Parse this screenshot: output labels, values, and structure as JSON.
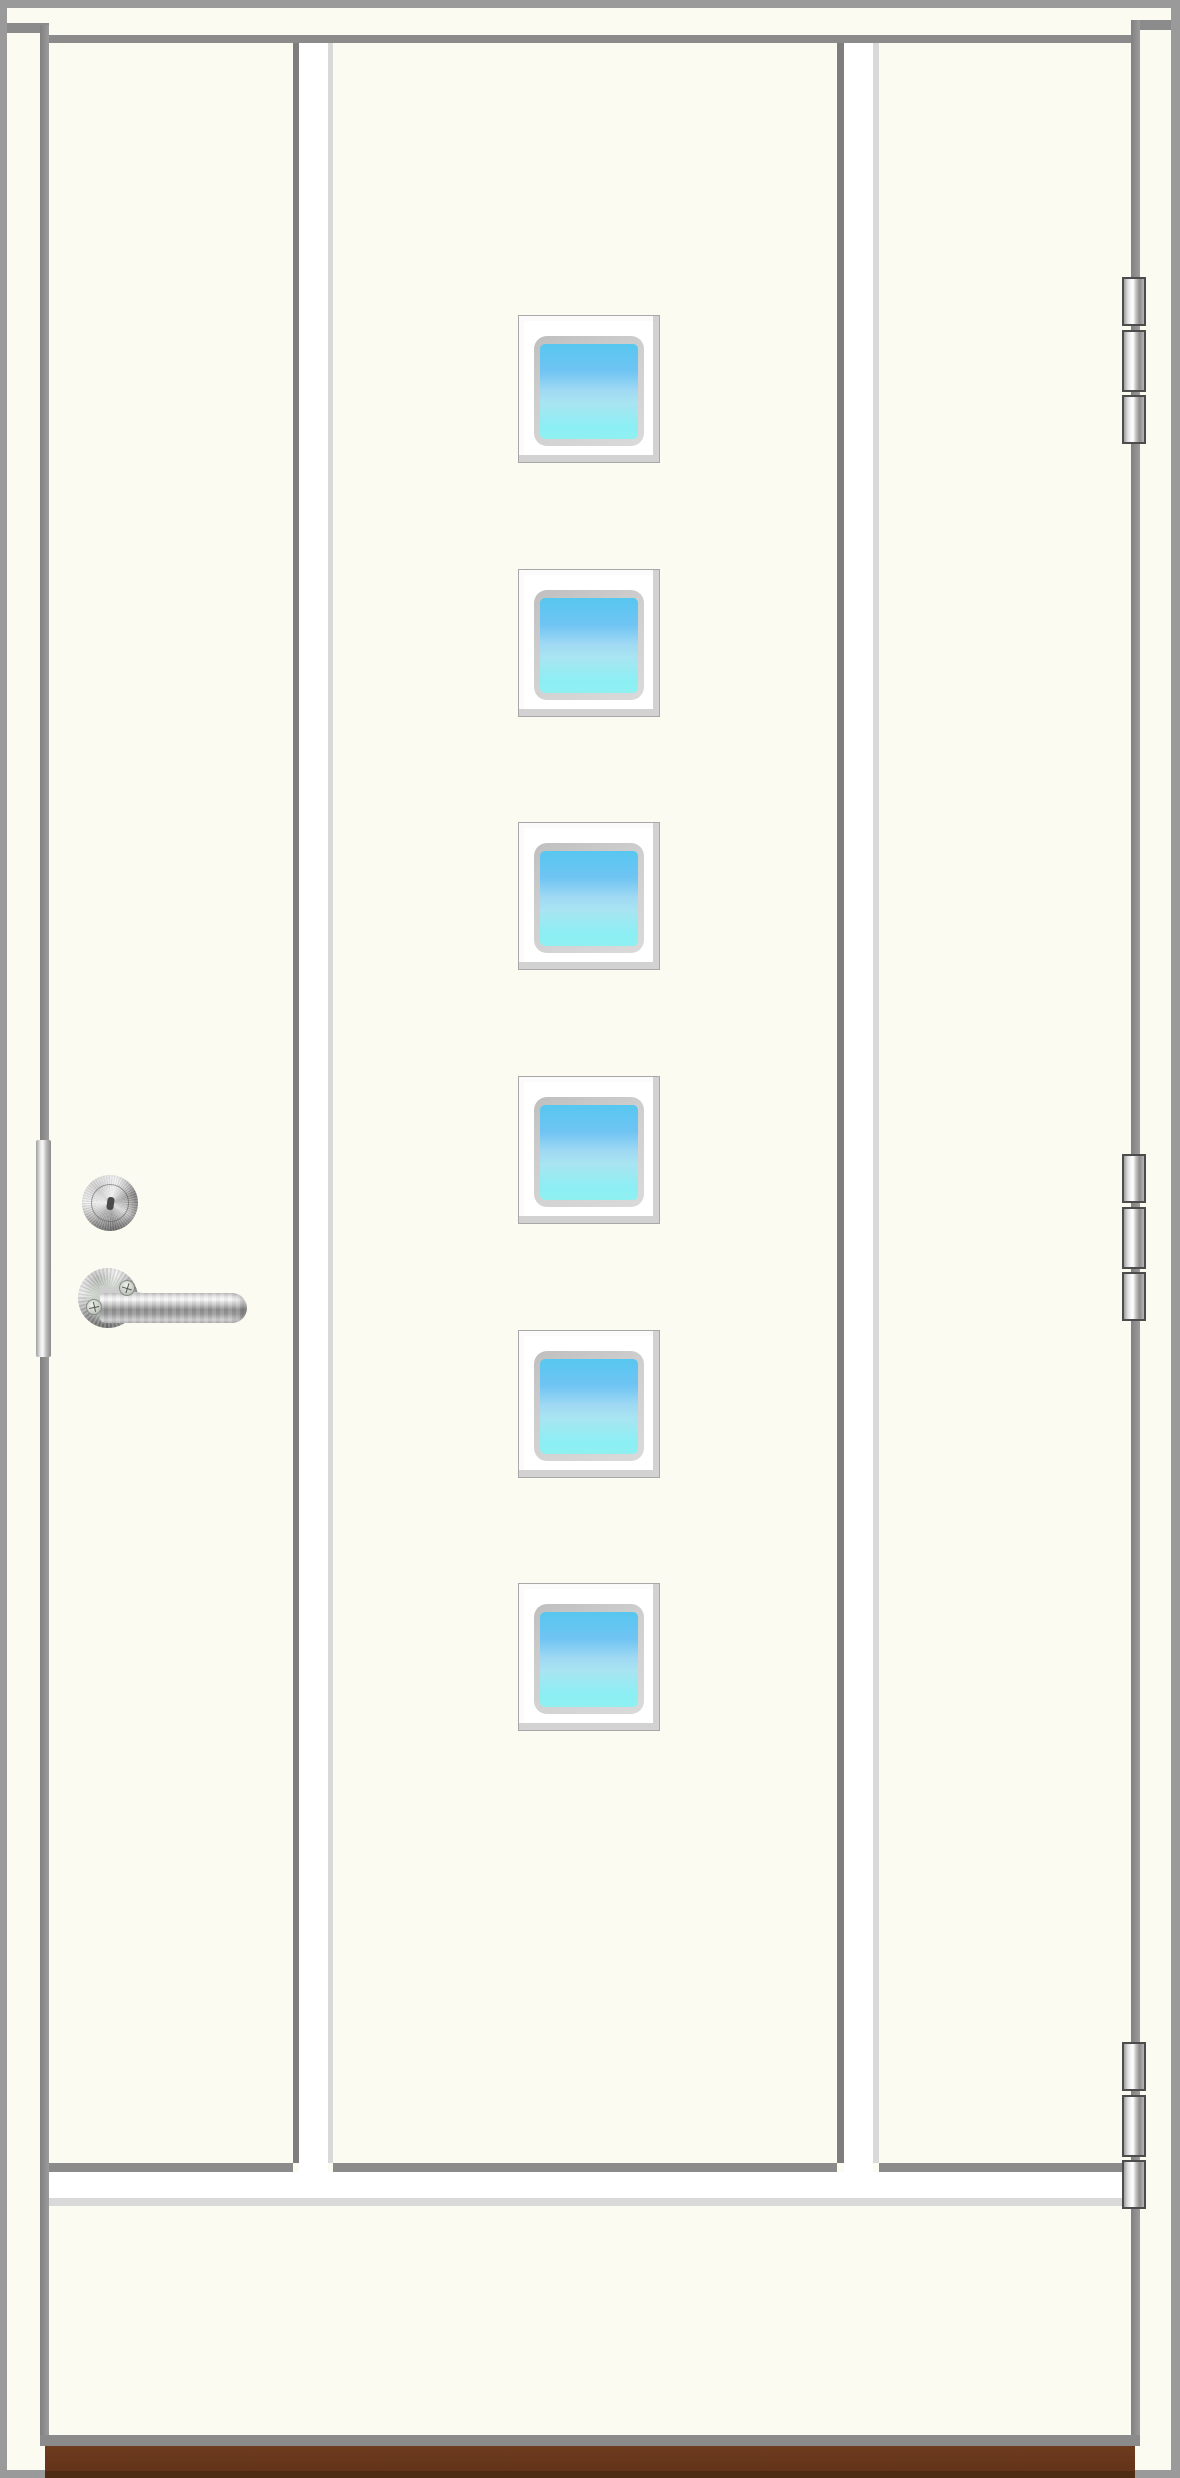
{
  "scene": {
    "kind": "exterior-door-product-illustration",
    "description": "White exterior entry door with six stacked square glass panes, stainless lever handle, keyed lock cylinder, edge strike plate, three hinges and brown threshold"
  },
  "door": {
    "panel_count": 3,
    "window_count": 6,
    "window_tops": [
      315,
      569,
      822,
      1076,
      1330,
      1583
    ],
    "hinge_count": 3,
    "hinge_tops": [
      277,
      1154,
      2042
    ],
    "hinge_knuckles": [
      {
        "offset": 0,
        "height": 49
      },
      {
        "offset": 53,
        "height": 62
      },
      {
        "offset": 118,
        "height": 49
      }
    ],
    "hardware_icons": [
      "lock-cylinder-icon",
      "lever-handle-icon",
      "hinge-icon",
      "strike-plate-icon",
      "screw-icon"
    ]
  },
  "colors": {
    "door_surface": "#FCFBF1",
    "outer_frame": "#9A9A9A",
    "panel_line": "#8B8B8B",
    "groove_shadow": "#7E7E7E",
    "groove_highlight": "#D9D9D9",
    "groove_white": "#FFFFFF",
    "window_frame": "#FFFFFF",
    "window_inset": "#C8C8C8",
    "glass_top": "#57C7F0",
    "glass_middle": "#9ED8F3",
    "glass_bottom": "#8BEFF3",
    "hinge_border": "#4C4C4C",
    "threshold_top": "#6E3B1E",
    "threshold_bottom": "#4E2B13"
  }
}
